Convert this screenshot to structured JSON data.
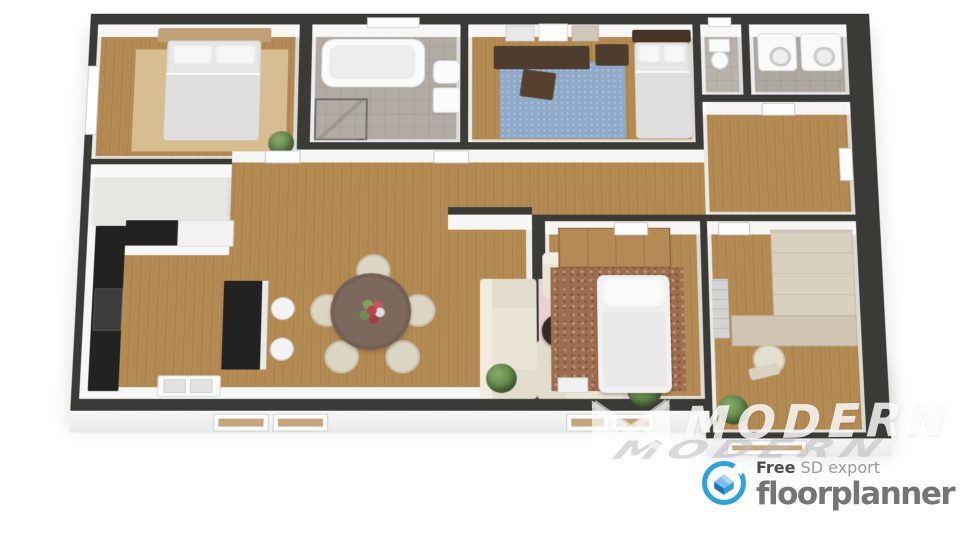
{
  "branding": {
    "watermark": {
      "text": "MODERN",
      "mark": "bowtie-m-logo"
    },
    "exporter": {
      "free_label": "Free",
      "export_label": " SD export",
      "product_name": "floorplanner"
    }
  },
  "palette": {
    "wall": "#3a3a37",
    "wall_face": "#f4f4f4",
    "wood_floor": "#b38a52",
    "tile_floor": "#b2aba3",
    "light_floor": "#e9e7e3",
    "rug_beige": "#d9bd92",
    "rug_blue": "#8fa9c9",
    "rug_pink": "#e6d2d2",
    "rug_rust": "#9e6e4e",
    "sofa_cream": "#ebe5d5",
    "counter_black": "#222222",
    "wood_furniture": "#4e3d2f",
    "plant_green": "#5e8048",
    "brand_blue": "#2aa3df",
    "text_gray": "#757575",
    "watermark_white": "rgba(255,255,255,0.82)"
  },
  "scene": {
    "type": "3d-floorplan-render",
    "rooms": [
      {
        "name": "bedroom-1",
        "floor": "wood",
        "furniture": [
          "double-bed",
          "wood-headboard",
          "beige-rug",
          "plant",
          "window"
        ]
      },
      {
        "name": "bathroom",
        "floor": "tile",
        "furniture": [
          "bathtub",
          "shower",
          "toilet",
          "sink",
          "window"
        ]
      },
      {
        "name": "bedroom-2",
        "floor": "wood",
        "furniture": [
          "double-bed",
          "dark-headboard",
          "desk",
          "desk-chair",
          "nightstand",
          "blue-rug",
          "wall-art"
        ]
      },
      {
        "name": "wc",
        "floor": "tile",
        "furniture": [
          "toilet",
          "window"
        ]
      },
      {
        "name": "laundry-room",
        "floor": "tile",
        "furniture": [
          "washing-machine",
          "dryer"
        ]
      },
      {
        "name": "hallway",
        "floor": "wood",
        "furniture": [
          "doors"
        ]
      },
      {
        "name": "entry-closet",
        "floor": "light",
        "furniture": []
      },
      {
        "name": "kitchen",
        "floor": "wood",
        "furniture": [
          "l-shaped-counter",
          "stove",
          "island",
          "bar-stools",
          "sink-unit"
        ]
      },
      {
        "name": "living-dining-room",
        "floor": "wood",
        "furniture": [
          "round-dining-table",
          "dining-chairs",
          "l-shaped-sofa",
          "coffee-table",
          "armchair",
          "pink-rug",
          "plants"
        ]
      },
      {
        "name": "bedroom-3",
        "floor": "wood",
        "furniture": [
          "bed",
          "wardrobe",
          "rust-rug"
        ]
      },
      {
        "name": "office",
        "floor": "wood",
        "furniture": [
          "corner-cabinet",
          "desk",
          "office-chair",
          "tufted-panel",
          "plant"
        ]
      }
    ]
  }
}
